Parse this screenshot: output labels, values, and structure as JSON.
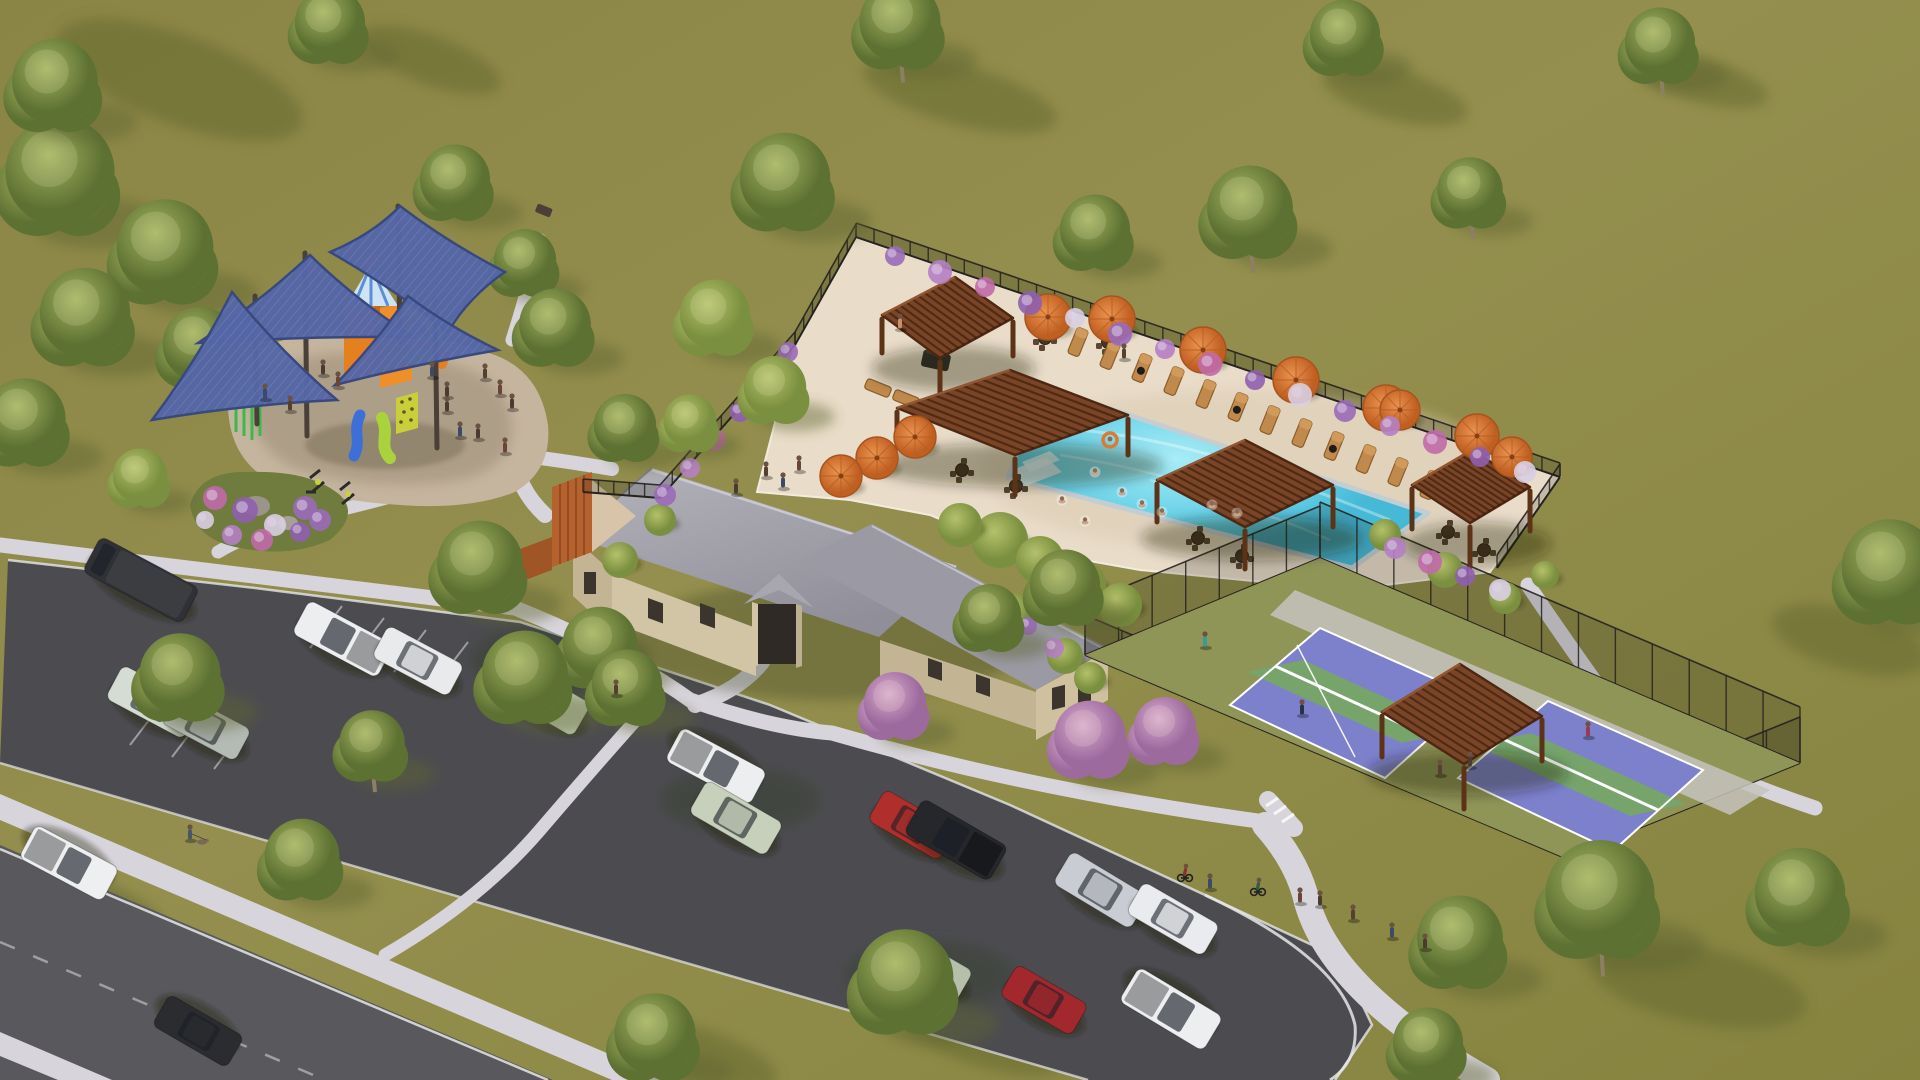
{
  "scene": {
    "description": "aerial 3d rendering of community amenity center with pool, clubhouse, playground, pickleball courts, parking lot and road",
    "palette": {
      "grass": "#8e8948",
      "grass_light": "#9a9553",
      "grass_shadow": "#63682f",
      "tree_green": "#6d823c",
      "tree_light": "#93a452",
      "tree_pink": "#b07fae",
      "trunk": "#8d7f63",
      "road": "#59595d",
      "asphalt": "#4c4c50",
      "sidewalk": "#d7d4db",
      "curb": "#e8e8ea",
      "deck": "#e9dcc8",
      "pool_water": "#55c6e0",
      "pool_water_light": "#a8ecf6",
      "pool_tile": "#c2ced2",
      "pergola": "#7a4526",
      "pergola_dark": "#4e2713",
      "umbrella": "#d9742f",
      "umbrella_dark": "#a8541e",
      "lounger": "#c08a4c",
      "fence": "#26221f",
      "sail": "#5566a6",
      "sail_dark": "#39497e",
      "play_orange": "#e5801f",
      "play_lime": "#a9d23c",
      "play_blue": "#3e6fd8",
      "play_green": "#3db84a",
      "court_purple": "#7d81cc",
      "court_green": "#76a46b",
      "court_line": "#ffffff",
      "stone": "#d2c5a6",
      "stone_shade": "#c3b493",
      "roof": "#a8a7b0",
      "roof_dark": "#93929b",
      "mulch": "#c6b59e",
      "cedar": "#b5622f",
      "flower_purple": "#9a6ab8",
      "flower_pink": "#c06aa8"
    },
    "areas": {
      "pool": "swimming pool",
      "pool_deck": "pool deck",
      "clubhouse": "clubhouse building",
      "playground": "playground with shade sails",
      "courts": "pickleball courts",
      "parking": "parking lot",
      "road": "street",
      "lawn": "open lawn"
    },
    "trees": [
      [
        60,
        180,
        70,
        "g"
      ],
      [
        165,
        255,
        62,
        "g"
      ],
      [
        85,
        320,
        58,
        "g"
      ],
      [
        200,
        350,
        48,
        "g"
      ],
      [
        25,
        425,
        52,
        "g"
      ],
      [
        330,
        28,
        45,
        "g"
      ],
      [
        55,
        88,
        55,
        "g"
      ],
      [
        900,
        28,
        52,
        "gt"
      ],
      [
        785,
        185,
        58,
        "g"
      ],
      [
        525,
        265,
        40,
        "g"
      ],
      [
        455,
        185,
        45,
        "g"
      ],
      [
        555,
        330,
        46,
        "g"
      ],
      [
        625,
        430,
        40,
        "g"
      ],
      [
        140,
        480,
        35,
        "l"
      ],
      [
        480,
        570,
        55,
        "g"
      ],
      [
        600,
        650,
        48,
        "g"
      ],
      [
        180,
        680,
        52,
        "g"
      ],
      [
        372,
        748,
        42,
        "gt"
      ],
      [
        655,
        1040,
        52,
        "g"
      ],
      [
        905,
        985,
        62,
        "g"
      ],
      [
        302,
        862,
        48,
        "g"
      ],
      [
        525,
        680,
        55,
        "g"
      ],
      [
        627,
        690,
        45,
        "g"
      ],
      [
        1095,
        235,
        45,
        "g"
      ],
      [
        1250,
        215,
        55,
        "gt"
      ],
      [
        1470,
        195,
        42,
        "gt"
      ],
      [
        1345,
        40,
        45,
        "g"
      ],
      [
        1660,
        48,
        45,
        "gt"
      ],
      [
        715,
        320,
        45,
        "l"
      ],
      [
        775,
        392,
        40,
        "l"
      ],
      [
        690,
        425,
        34,
        "l"
      ],
      [
        1065,
        590,
        45,
        "g"
      ],
      [
        990,
        620,
        40,
        "g"
      ],
      [
        895,
        708,
        40,
        "p"
      ],
      [
        1090,
        742,
        46,
        "p"
      ],
      [
        1165,
        733,
        40,
        "p"
      ],
      [
        1890,
        575,
        62,
        "g"
      ],
      [
        1600,
        903,
        70,
        "gt"
      ],
      [
        1460,
        945,
        55,
        "g"
      ],
      [
        1428,
        1048,
        45,
        "g"
      ],
      [
        1800,
        900,
        58,
        "g"
      ]
    ],
    "cars": [
      {
        "x": 141,
        "y": 580,
        "l": 112,
        "w": 40,
        "r": 28,
        "c": "#303136",
        "k": "van",
        "name": "dark-van"
      },
      {
        "x": 343,
        "y": 639,
        "l": 96,
        "w": 38,
        "r": 28,
        "c": "#eceef0",
        "k": "pickup",
        "name": "white-pickup"
      },
      {
        "x": 418,
        "y": 661,
        "l": 86,
        "w": 36,
        "r": 28,
        "c": "#e8eaec",
        "k": "sedan",
        "name": "white-sedan"
      },
      {
        "x": 153,
        "y": 702,
        "l": 88,
        "w": 38,
        "r": 28,
        "c": "#d4dcd4",
        "k": "suv",
        "name": "white-suv"
      },
      {
        "x": 206,
        "y": 726,
        "l": 84,
        "w": 36,
        "r": 28,
        "c": "#b4bab4",
        "k": "sedan",
        "name": "gray-sedan"
      },
      {
        "x": 543,
        "y": 698,
        "l": 90,
        "w": 38,
        "r": 30,
        "c": "#c2cdb4",
        "k": "suv",
        "name": "shaded-suv"
      },
      {
        "x": 716,
        "y": 766,
        "l": 96,
        "w": 38,
        "r": 208,
        "c": "#eceef0",
        "k": "pickup",
        "name": "white-pickup-2"
      },
      {
        "x": 736,
        "y": 818,
        "l": 88,
        "w": 38,
        "r": 30,
        "c": "#c6d0ba",
        "k": "suv",
        "name": "shaded-suv-2"
      },
      {
        "x": 912,
        "y": 825,
        "l": 82,
        "w": 36,
        "r": 30,
        "c": "#b02f2c",
        "k": "sedan",
        "name": "red-hatchback"
      },
      {
        "x": 956,
        "y": 840,
        "l": 98,
        "w": 40,
        "r": 30,
        "c": "#26272b",
        "k": "pickup",
        "name": "black-pickup"
      },
      {
        "x": 1101,
        "y": 890,
        "l": 90,
        "w": 38,
        "r": 31,
        "c": "#c9cdd3",
        "k": "suv",
        "name": "silver-minivan"
      },
      {
        "x": 1173,
        "y": 919,
        "l": 88,
        "w": 36,
        "r": 30,
        "c": "#e9ebee",
        "k": "sedan",
        "name": "white-sedan-2"
      },
      {
        "x": 1044,
        "y": 1000,
        "l": 82,
        "w": 36,
        "r": 30,
        "c": "#a2282e",
        "k": "sedan",
        "name": "red-car"
      },
      {
        "x": 1171,
        "y": 1009,
        "l": 98,
        "w": 40,
        "r": 211,
        "c": "#eceef0",
        "k": "pickup",
        "name": "white-pickup-3"
      },
      {
        "x": 928,
        "y": 966,
        "l": 84,
        "w": 36,
        "r": 30,
        "c": "#b6bfaa",
        "k": "sedan",
        "name": "shaded-sedan"
      },
      {
        "x": 69,
        "y": 863,
        "l": 94,
        "w": 38,
        "r": 208,
        "c": "#edeff1",
        "k": "pickup",
        "name": "road-pickup"
      },
      {
        "x": 198,
        "y": 1031,
        "l": 86,
        "w": 36,
        "r": 210,
        "c": "#2b2c30",
        "k": "sedan",
        "name": "road-black-sedan"
      }
    ],
    "umbrellas": [
      [
        1048,
        317,
        23
      ],
      [
        1112,
        319,
        23
      ],
      [
        1203,
        350,
        23
      ],
      [
        1296,
        380,
        23
      ],
      [
        1386,
        408,
        23
      ],
      [
        915,
        437,
        21
      ],
      [
        877,
        458,
        21
      ],
      [
        841,
        476,
        21
      ],
      [
        1477,
        436,
        22
      ],
      [
        1512,
        457,
        20
      ],
      [
        1400,
        410,
        20
      ]
    ],
    "loungers": {
      "row": {
        "x0": 1078,
        "y0": 342,
        "dx": 32,
        "dy": 13,
        "count": 12,
        "towels": [
          2,
          5,
          8
        ]
      },
      "extra": [
        [
          878,
          388
        ],
        [
          906,
          399
        ]
      ]
    },
    "pergolas": [
      {
        "name": "outdoor-kitchen-pergola",
        "pts": [
          [
            882,
            315
          ],
          [
            955,
            277
          ],
          [
            1013,
            318
          ],
          [
            940,
            358
          ]
        ],
        "h": 38
      },
      {
        "name": "main-pool-pergola",
        "pts": [
          [
            897,
            408
          ],
          [
            1010,
            370
          ],
          [
            1128,
            415
          ],
          [
            1015,
            455
          ]
        ],
        "h": 40
      },
      {
        "name": "pool-pergola-south",
        "pts": [
          [
            1157,
            480
          ],
          [
            1245,
            440
          ],
          [
            1333,
            485
          ],
          [
            1245,
            527
          ]
        ],
        "h": 42
      },
      {
        "name": "pool-pergola-east",
        "pts": [
          [
            1412,
            485
          ],
          [
            1472,
            450
          ],
          [
            1530,
            487
          ],
          [
            1470,
            523
          ]
        ],
        "h": 44
      },
      {
        "name": "court-pergola",
        "pts": [
          [
            1382,
            712
          ],
          [
            1460,
            664
          ],
          [
            1542,
            716
          ],
          [
            1464,
            764
          ]
        ],
        "h": 45
      }
    ],
    "sails": [
      {
        "pts": [
          [
            330,
            252
          ],
          [
            400,
            206
          ],
          [
            505,
            272
          ],
          [
            448,
            332
          ]
        ]
      },
      {
        "pts": [
          [
            198,
            343
          ],
          [
            310,
            255
          ],
          [
            413,
            337
          ]
        ]
      },
      {
        "pts": [
          [
            152,
            420
          ],
          [
            232,
            292
          ],
          [
            337,
            400
          ]
        ]
      },
      {
        "pts": [
          [
            335,
            385
          ],
          [
            408,
            296
          ],
          [
            498,
            350
          ]
        ]
      }
    ],
    "sail_posts": [
      [
        305,
        253,
        436
      ],
      [
        398,
        206,
        342
      ],
      [
        435,
        298,
        448
      ],
      [
        255,
        296,
        424
      ]
    ],
    "fences": [
      {
        "x1": 583,
        "y1": 492,
        "x2": 660,
        "y2": 498,
        "h": 13,
        "step": 16
      },
      {
        "x1": 660,
        "y1": 498,
        "x2": 795,
        "y2": 345,
        "h": 13,
        "step": 18
      },
      {
        "x1": 795,
        "y1": 345,
        "x2": 856,
        "y2": 237,
        "h": 13,
        "step": 18
      },
      {
        "x1": 856,
        "y1": 237,
        "x2": 1560,
        "y2": 477,
        "h": 14,
        "step": 19
      },
      {
        "x1": 1560,
        "y1": 477,
        "x2": 1497,
        "y2": 568,
        "h": 13,
        "step": 18
      },
      {
        "x1": 1085,
        "y1": 655,
        "x2": 1320,
        "y2": 558,
        "h": 52,
        "step": 38
      },
      {
        "x1": 1320,
        "y1": 558,
        "x2": 1800,
        "y2": 763,
        "h": 56,
        "step": 40
      },
      {
        "x1": 1800,
        "y1": 763,
        "x2": 1565,
        "y2": 858,
        "h": 46,
        "step": 38
      },
      {
        "x1": 1565,
        "y1": 858,
        "x2": 1085,
        "y2": 655,
        "h": 40,
        "step": 40
      }
    ],
    "flowers": [
      [
        895,
        256,
        10
      ],
      [
        940,
        272,
        12
      ],
      [
        985,
        287,
        10
      ],
      [
        1030,
        303,
        12
      ],
      [
        1075,
        318,
        10
      ],
      [
        1120,
        334,
        12
      ],
      [
        1165,
        349,
        10
      ],
      [
        1210,
        364,
        12
      ],
      [
        1255,
        380,
        10
      ],
      [
        1300,
        395,
        12
      ],
      [
        1345,
        411,
        11
      ],
      [
        1390,
        426,
        10
      ],
      [
        1435,
        442,
        12
      ],
      [
        1480,
        457,
        10
      ],
      [
        1525,
        472,
        11
      ],
      [
        665,
        495,
        11
      ],
      [
        690,
        468,
        10
      ],
      [
        715,
        440,
        11
      ],
      [
        740,
        412,
        10
      ],
      [
        765,
        385,
        11
      ],
      [
        788,
        352,
        10
      ],
      [
        1395,
        548,
        11
      ],
      [
        1430,
        562,
        12
      ],
      [
        1465,
        576,
        10
      ],
      [
        1500,
        590,
        11
      ],
      [
        1028,
        626,
        9
      ],
      [
        1054,
        648,
        10
      ],
      [
        215,
        498,
        12
      ],
      [
        245,
        510,
        13
      ],
      [
        275,
        525,
        11
      ],
      [
        305,
        508,
        12
      ],
      [
        232,
        535,
        10
      ],
      [
        262,
        540,
        11
      ],
      [
        300,
        532,
        10
      ],
      [
        205,
        520,
        9
      ],
      [
        320,
        520,
        11
      ]
    ],
    "bushes": [
      [
        1000,
        540,
        28
      ],
      [
        1040,
        560,
        24
      ],
      [
        1080,
        585,
        26
      ],
      [
        1120,
        605,
        22
      ],
      [
        960,
        525,
        22
      ],
      [
        1015,
        612,
        18
      ],
      [
        1065,
        656,
        18
      ],
      [
        1090,
        678,
        16
      ],
      [
        1385,
        535,
        16
      ],
      [
        1445,
        570,
        18
      ],
      [
        1505,
        598,
        16
      ],
      [
        1545,
        575,
        14
      ],
      [
        620,
        560,
        18
      ],
      [
        660,
        520,
        16
      ]
    ],
    "people": [
      [
        766,
        470,
        "s",
        "#55402f"
      ],
      [
        783,
        481,
        "s",
        "#3c4a63"
      ],
      [
        799,
        464,
        "s",
        "#6b4438"
      ],
      [
        736,
        487,
        "s",
        "#4a3a30"
      ],
      [
        900,
        322,
        "s",
        "#c98f6a"
      ],
      [
        1124,
        352,
        "s",
        "#55402f"
      ],
      [
        1095,
        472,
        "w",
        ""
      ],
      [
        1122,
        492,
        "w",
        ""
      ],
      [
        1142,
        504,
        "w",
        ""
      ],
      [
        1162,
        512,
        "w",
        ""
      ],
      [
        1212,
        505,
        "w",
        ""
      ],
      [
        1237,
        513,
        "w",
        ""
      ],
      [
        1062,
        500,
        "w",
        ""
      ],
      [
        1085,
        521,
        "w",
        ""
      ],
      [
        1110,
        440,
        "f",
        ""
      ],
      [
        323,
        368,
        "s",
        "#4a3a30"
      ],
      [
        338,
        380,
        "s",
        "#6b4438"
      ],
      [
        432,
        370,
        "s",
        "#3c4a63"
      ],
      [
        447,
        390,
        "s",
        "#4a3a30"
      ],
      [
        485,
        372,
        "s",
        "#55402f"
      ],
      [
        500,
        388,
        "s",
        "#6b4438"
      ],
      [
        512,
        402,
        "s",
        "#4a3a30"
      ],
      [
        265,
        392,
        "s",
        "#3c4a63"
      ],
      [
        290,
        404,
        "s",
        "#55402f"
      ],
      [
        478,
        432,
        "s",
        "#4a3a30"
      ],
      [
        505,
        446,
        "s",
        "#6b4438"
      ],
      [
        447,
        405,
        "s",
        "#4a3a30"
      ],
      [
        460,
        430,
        "s",
        "#3c4a63"
      ],
      [
        190,
        833,
        "s",
        "#46566b"
      ],
      [
        616,
        688,
        "s",
        "#55402f"
      ],
      [
        1185,
        872,
        "b",
        "#8a3030"
      ],
      [
        1210,
        882,
        "s",
        "#3c4a63"
      ],
      [
        1258,
        886,
        "b",
        "#2f5a46"
      ],
      [
        1300,
        896,
        "s",
        "#6b4438"
      ],
      [
        1320,
        899,
        "s",
        "#4a3a30"
      ],
      [
        1353,
        913,
        "s",
        "#55402f"
      ],
      [
        1392,
        931,
        "s",
        "#3c4a63"
      ],
      [
        1425,
        942,
        "s",
        "#4a3a30"
      ],
      [
        1205,
        640,
        "s",
        "#3a9a9a"
      ],
      [
        1302,
        708,
        "s",
        "#28304a"
      ],
      [
        1588,
        730,
        "s",
        "#9a3a4a"
      ],
      [
        1470,
        760,
        "s",
        "#4a3a30"
      ],
      [
        1440,
        768,
        "s",
        "#55402f"
      ],
      [
        202,
        842,
        "d",
        ""
      ]
    ],
    "tables": [
      [
        962,
        470
      ],
      [
        1016,
        486
      ],
      [
        1198,
        538
      ],
      [
        1242,
        556
      ],
      [
        1448,
        532
      ],
      [
        1484,
        550
      ],
      [
        1045,
        338
      ],
      [
        1108,
        342
      ]
    ],
    "shadows": [
      [
        180,
        80,
        130,
        45,
        20
      ],
      [
        430,
        60,
        75,
        25,
        20
      ],
      [
        960,
        95,
        100,
        30,
        15
      ],
      [
        1395,
        95,
        75,
        25,
        15
      ],
      [
        1700,
        80,
        70,
        22,
        15
      ],
      [
        1698,
        985,
        110,
        38,
        12
      ],
      [
        1850,
        640,
        80,
        30,
        15
      ],
      [
        95,
        905,
        75,
        25,
        20
      ],
      [
        700,
        1055,
        80,
        26,
        18
      ],
      [
        980,
        1035,
        90,
        30,
        18
      ]
    ]
  }
}
